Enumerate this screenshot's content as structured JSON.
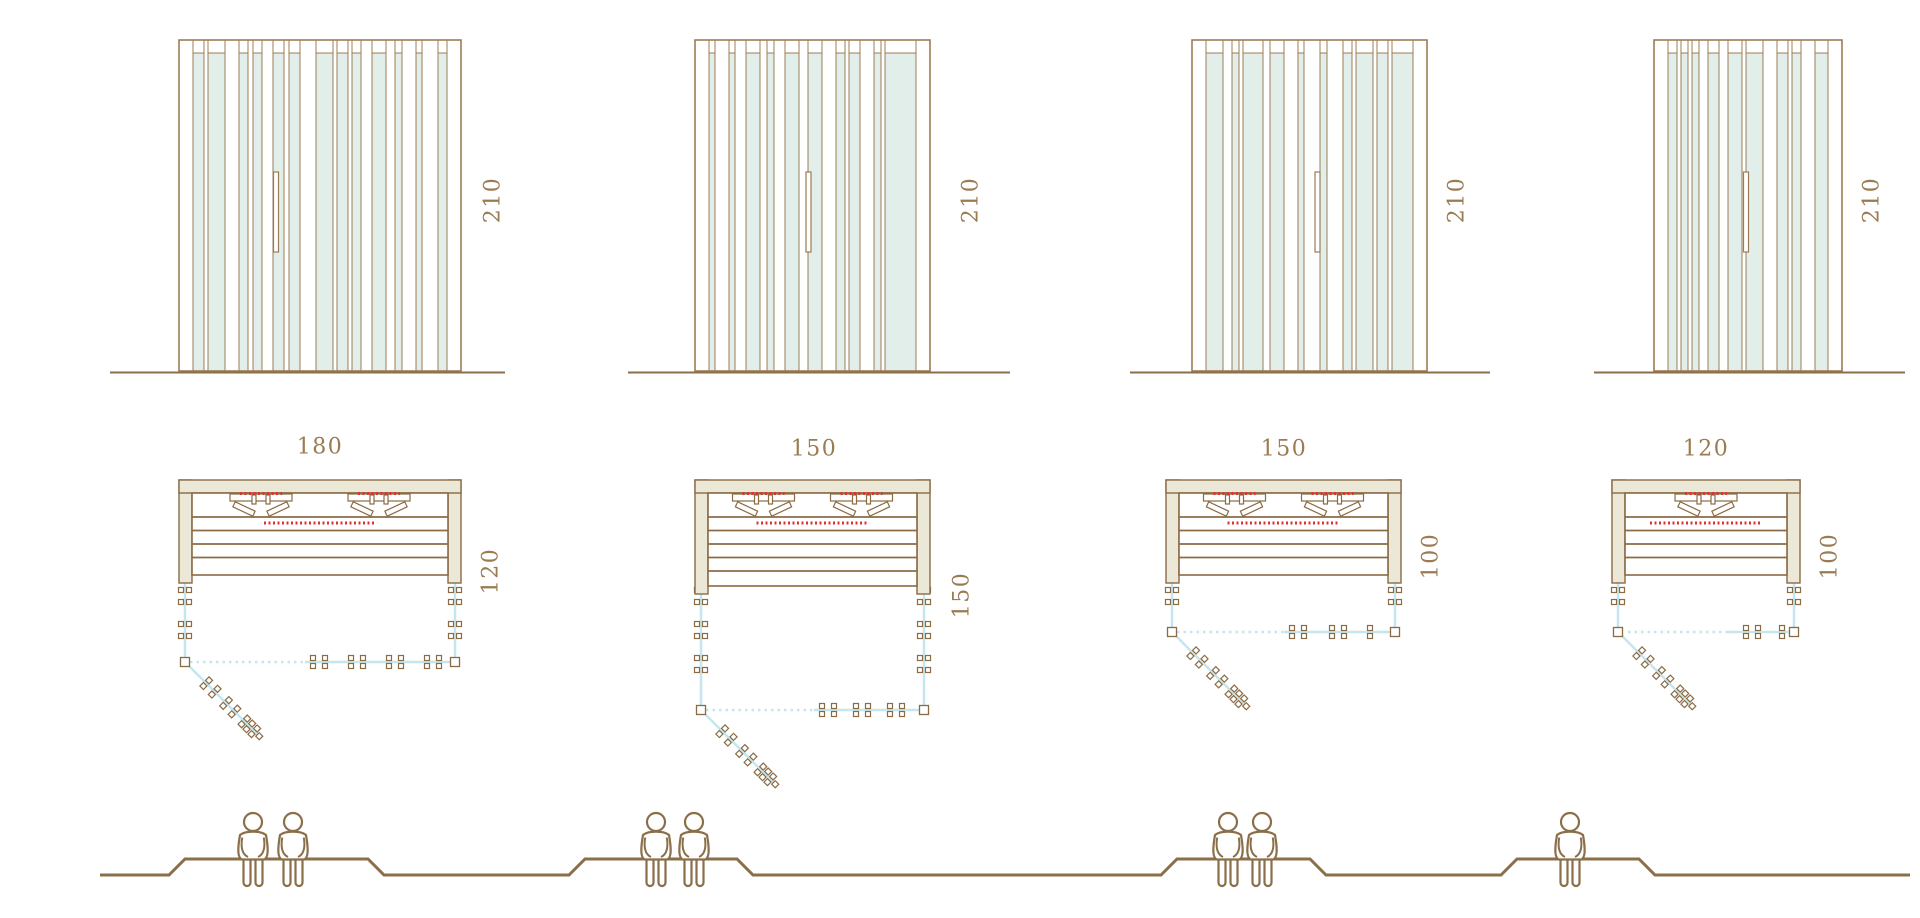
{
  "diagram": {
    "title": "sauna-cabin-size-comparison",
    "models": [
      {
        "id": 1,
        "width_cm": "180",
        "depth_cm": "120",
        "height_cm": "210",
        "seats": 2
      },
      {
        "id": 2,
        "width_cm": "150",
        "depth_cm": "150",
        "height_cm": "210",
        "seats": 2
      },
      {
        "id": 3,
        "width_cm": "150",
        "depth_cm": "100",
        "height_cm": "210",
        "seats": 2
      },
      {
        "id": 4,
        "width_cm": "120",
        "depth_cm": "100",
        "height_cm": "210",
        "seats": 1
      }
    ],
    "colors": {
      "line_brown": "#9c7c55",
      "dark_brown": "#8a6b44",
      "ground_brown": "#8a6f4a",
      "beige_fill": "#ece8d8",
      "glass_fill": "#e1eeea",
      "glass_line": "#c5e6ee",
      "heater_red": "#e03030",
      "label_text": "#9b7b52",
      "background": "#ffffff"
    }
  }
}
